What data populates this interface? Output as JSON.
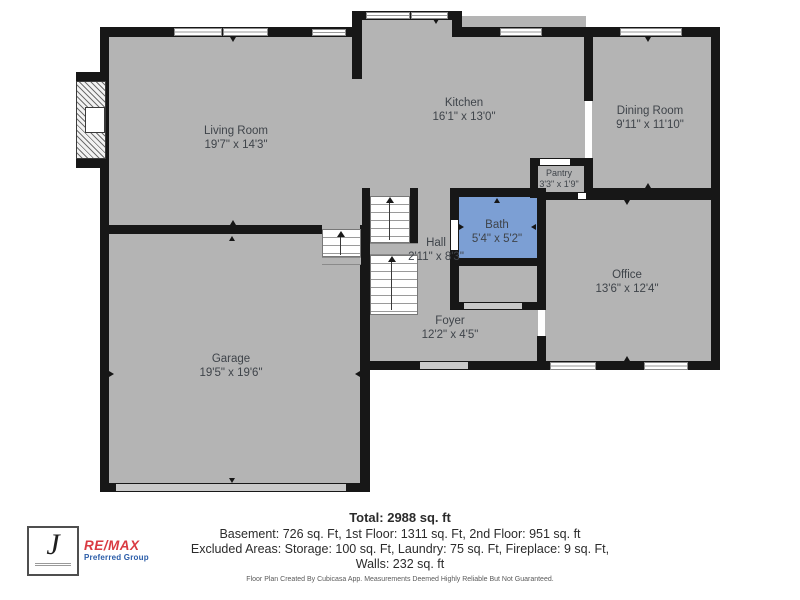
{
  "rooms": {
    "living": {
      "name": "Living Room",
      "dims": "19'7\" x 14'3\""
    },
    "kitchen": {
      "name": "Kitchen",
      "dims": "16'1\" x 13'0\""
    },
    "dining": {
      "name": "Dining Room",
      "dims": "9'11\" x 11'10\""
    },
    "pantry": {
      "name": "Pantry",
      "dims": "3'3\" x 1'9\""
    },
    "bath": {
      "name": "Bath",
      "dims": "5'4\" x 5'2\""
    },
    "hall": {
      "name": "Hall",
      "dims": "2'11\" x 8'3\""
    },
    "office": {
      "name": "Office",
      "dims": "13'6\" x 12'4\""
    },
    "foyer": {
      "name": "Foyer",
      "dims": "12'2\" x 4'5\""
    },
    "garage": {
      "name": "Garage",
      "dims": "19'5\" x 19'6\""
    }
  },
  "summary": {
    "total": "Total: 2988 sq. ft",
    "line1": "Basement: 726 sq. Ft, 1st Floor: 1311 sq. Ft, 2nd Floor: 951 sq. ft",
    "line2": "Excluded Areas: Storage: 100 sq. Ft, Laundry: 75 sq. Ft, Fireplace: 9 sq. Ft,",
    "line3": "Walls: 232 sq. ft",
    "disclaimer": "Floor Plan Created By Cubicasa App. Measurements Deemed Highly Reliable But Not Guaranteed."
  },
  "branding": {
    "logo_letter": "J",
    "brand_name": "RE/MAX",
    "brand_sub": "Preferred Group"
  },
  "colors": {
    "bath_fill": "#7c9fd4",
    "floor_gray": "#b4b4b4",
    "wall_black": "#171717",
    "remax_red": "#d93a41",
    "remax_blue": "#2a5ca8"
  }
}
